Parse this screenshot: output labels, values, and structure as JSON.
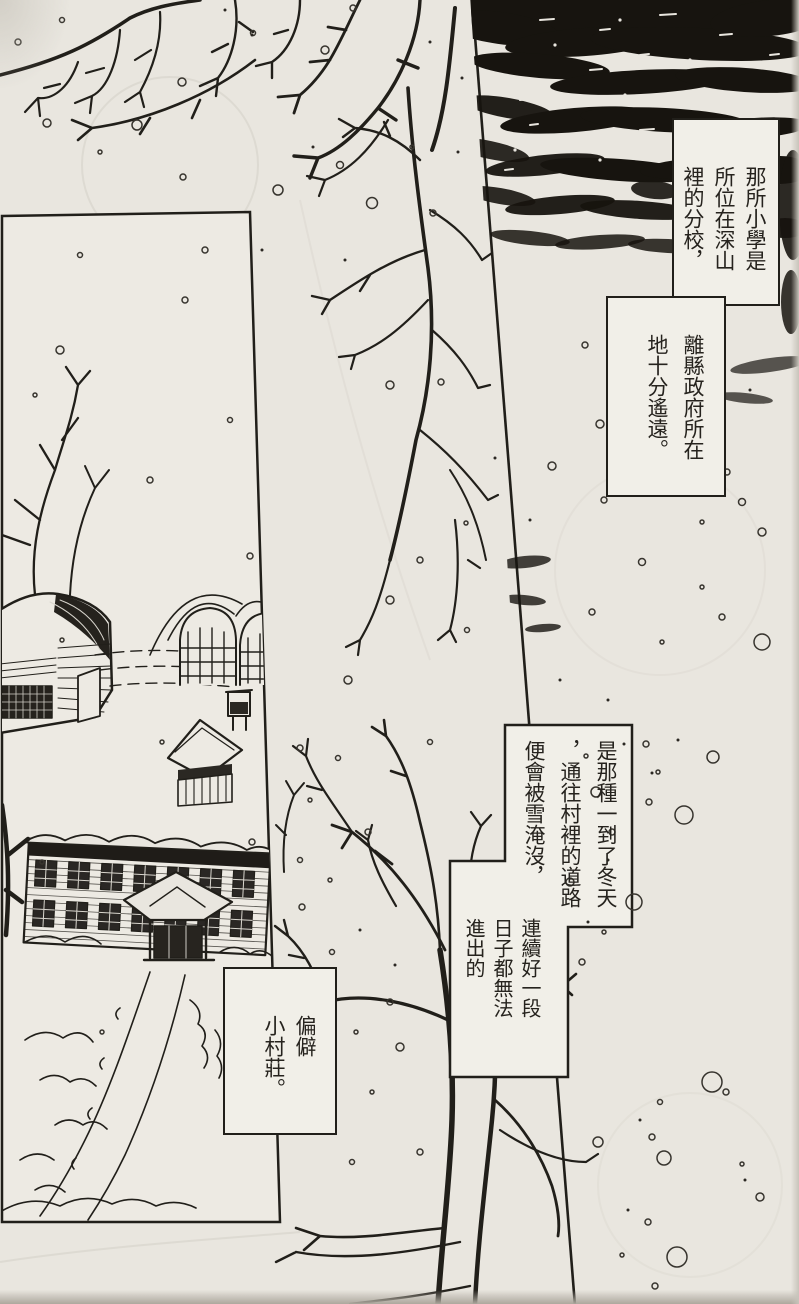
{
  "page": {
    "kind_label": "manga page",
    "reading_direction": "right-to-left vertical"
  },
  "captions": {
    "c1": {
      "text": "那所小學是\n所位在深山\n裡的分校，"
    },
    "c2": {
      "text": "離縣政府所在\n地十分遙遠。"
    },
    "c3a": {
      "text": "是那種一到了冬天\n，通往村裡的道路\n便會被雪淹沒，"
    },
    "c3b": {
      "text": "連續好一段\n日子都無法\n進出的"
    },
    "c4": {
      "text": "偏僻\n小村莊。"
    }
  },
  "colors": {
    "paper": "#e9e6df",
    "panel_fill": "#edeae3",
    "ink": "#211f1a",
    "night_sky": "#17140f",
    "caption_background": "#f1efe8",
    "caption_text": "#26231e"
  }
}
